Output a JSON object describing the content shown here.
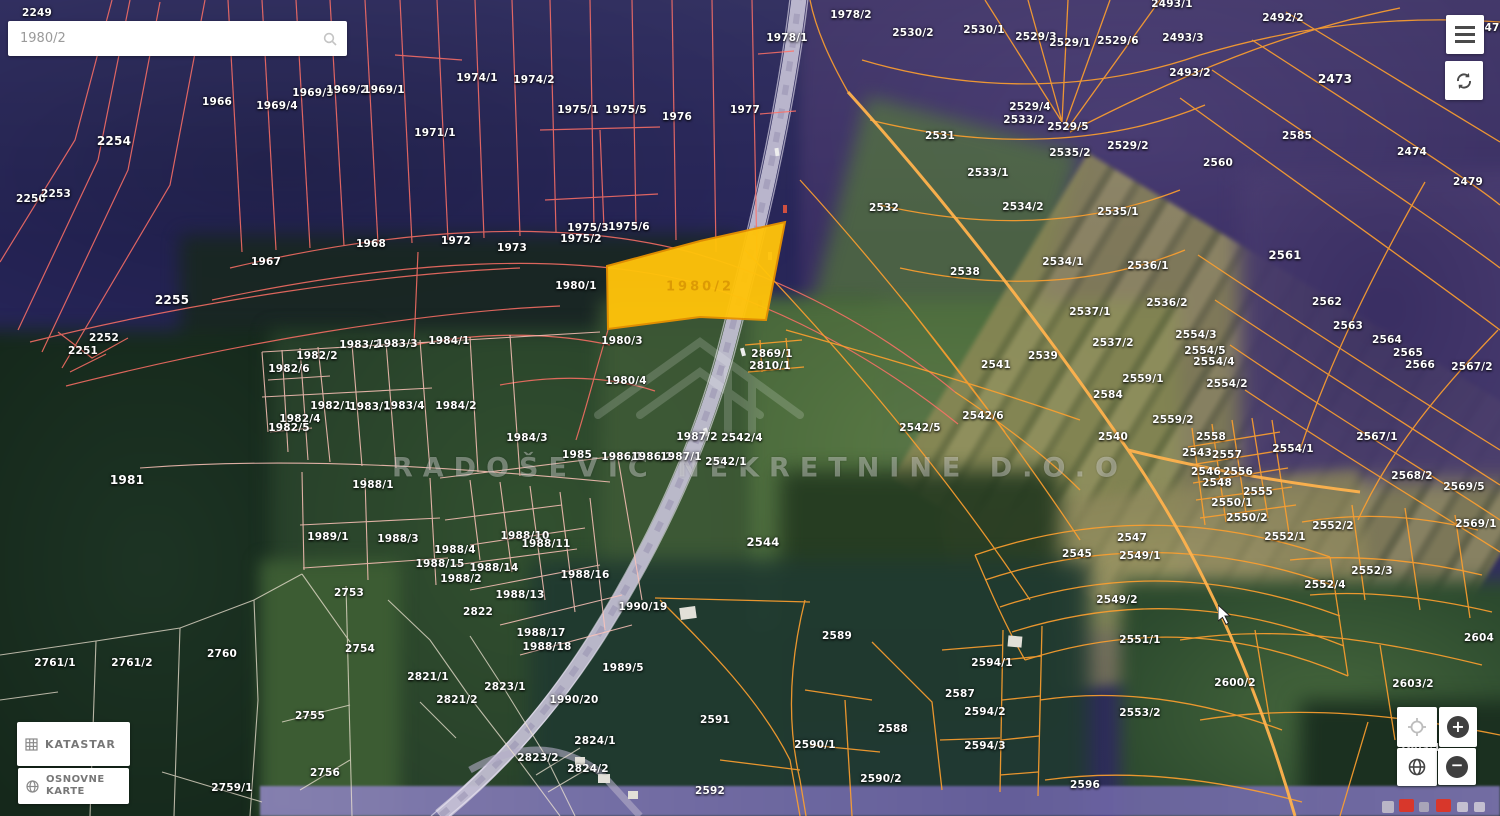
{
  "search": {
    "value": "1980/2",
    "icon": "magnifier-icon"
  },
  "topbar": {
    "menu_icon": "hamburger-icon",
    "refresh_icon": "sync-icon"
  },
  "buttons": {
    "katastar": "KATASTAR",
    "osnovne_karte": "OSNOVNE KARTE",
    "katastar_icon": "grid-icon",
    "osnovne_karte_icon": "globe-icon"
  },
  "controls": {
    "locate_icon": "crosshair-icon",
    "zoom_in": "+",
    "zoom_out": "−",
    "basemap_icon": "globe-icon"
  },
  "watermark": {
    "text": "RADOŠEVIĆ NEKRETNINE D.O.O",
    "logo": "house-logo"
  },
  "highlight": {
    "label": "1980/2",
    "fill": "#ffc30a",
    "stroke": "#e79100"
  },
  "colors": {
    "parcel_line_left": "#ff7066",
    "parcel_line_grid": "#ffc4ba",
    "parcel_line_right": "#ffa02e",
    "parcel_line_white": "#eee3d2",
    "highway": "#c6c1d6",
    "highlight_fill": "#ffc30a"
  },
  "map": {
    "parcels": [
      {
        "n": "2249",
        "x": 37,
        "y": 13
      },
      {
        "n": "1966",
        "x": 217,
        "y": 102
      },
      {
        "n": "1969/4",
        "x": 277,
        "y": 106
      },
      {
        "n": "1969/3",
        "x": 313,
        "y": 93
      },
      {
        "n": "1969/2",
        "x": 347,
        "y": 90
      },
      {
        "n": "1969/1",
        "x": 384,
        "y": 90
      },
      {
        "n": "1971/1",
        "x": 435,
        "y": 133
      },
      {
        "n": "1974/1",
        "x": 477,
        "y": 78
      },
      {
        "n": "1974/2",
        "x": 534,
        "y": 80
      },
      {
        "n": "1975/1",
        "x": 578,
        "y": 110
      },
      {
        "n": "1975/5",
        "x": 626,
        "y": 110
      },
      {
        "n": "1976",
        "x": 677,
        "y": 117
      },
      {
        "n": "1977",
        "x": 745,
        "y": 110
      },
      {
        "n": "1978/1",
        "x": 787,
        "y": 38
      },
      {
        "n": "1978/2",
        "x": 851,
        "y": 15
      },
      {
        "n": "2254",
        "x": 114,
        "y": 141,
        "s": 1.15
      },
      {
        "n": "2250",
        "x": 31,
        "y": 199
      },
      {
        "n": "2253",
        "x": 56,
        "y": 194
      },
      {
        "n": "2255",
        "x": 172,
        "y": 300,
        "s": 1.15
      },
      {
        "n": "2252",
        "x": 104,
        "y": 338
      },
      {
        "n": "2251",
        "x": 83,
        "y": 351
      },
      {
        "n": "1967",
        "x": 266,
        "y": 262
      },
      {
        "n": "1968",
        "x": 371,
        "y": 244
      },
      {
        "n": "1972",
        "x": 456,
        "y": 241
      },
      {
        "n": "1973",
        "x": 512,
        "y": 248
      },
      {
        "n": "1975/3",
        "x": 588,
        "y": 228
      },
      {
        "n": "1975/2",
        "x": 581,
        "y": 239
      },
      {
        "n": "1975/6",
        "x": 629,
        "y": 227
      },
      {
        "n": "1980/1",
        "x": 576,
        "y": 286
      },
      {
        "n": "1980/3",
        "x": 622,
        "y": 341
      },
      {
        "n": "1980/4",
        "x": 626,
        "y": 381
      },
      {
        "n": "1981",
        "x": 127,
        "y": 480,
        "s": 1.15
      },
      {
        "n": "1984/1",
        "x": 449,
        "y": 341
      },
      {
        "n": "1983/2",
        "x": 360,
        "y": 345
      },
      {
        "n": "1983/3",
        "x": 397,
        "y": 344
      },
      {
        "n": "1982/2",
        "x": 317,
        "y": 356
      },
      {
        "n": "1982/6",
        "x": 289,
        "y": 369
      },
      {
        "n": "1982/1",
        "x": 331,
        "y": 406
      },
      {
        "n": "1983/1",
        "x": 370,
        "y": 407
      },
      {
        "n": "1983/4",
        "x": 404,
        "y": 406
      },
      {
        "n": "1984/2",
        "x": 456,
        "y": 406
      },
      {
        "n": "1982/4",
        "x": 300,
        "y": 419
      },
      {
        "n": "1982/5",
        "x": 289,
        "y": 428
      },
      {
        "n": "1984/3",
        "x": 527,
        "y": 438
      },
      {
        "n": "1985",
        "x": 577,
        "y": 455
      },
      {
        "n": "1986/1",
        "x": 622,
        "y": 457
      },
      {
        "n": "1986/2",
        "x": 652,
        "y": 457
      },
      {
        "n": "1987/1",
        "x": 681,
        "y": 457
      },
      {
        "n": "1987/2",
        "x": 697,
        "y": 437
      },
      {
        "n": "2869/1",
        "x": 772,
        "y": 354
      },
      {
        "n": "2810/1",
        "x": 770,
        "y": 366
      },
      {
        "n": "2542/4",
        "x": 742,
        "y": 438
      },
      {
        "n": "2542/1",
        "x": 726,
        "y": 462
      },
      {
        "n": "2542/5",
        "x": 920,
        "y": 428
      },
      {
        "n": "2542/6",
        "x": 983,
        "y": 416
      },
      {
        "n": "2544",
        "x": 763,
        "y": 542,
        "s": 1.1
      },
      {
        "n": "1988/1",
        "x": 373,
        "y": 485
      },
      {
        "n": "1989/1",
        "x": 328,
        "y": 537
      },
      {
        "n": "1988/3",
        "x": 398,
        "y": 539
      },
      {
        "n": "1988/4",
        "x": 455,
        "y": 550
      },
      {
        "n": "1988/15",
        "x": 440,
        "y": 564
      },
      {
        "n": "1988/2",
        "x": 461,
        "y": 579
      },
      {
        "n": "1988/14",
        "x": 494,
        "y": 568
      },
      {
        "n": "1988/10",
        "x": 525,
        "y": 536
      },
      {
        "n": "1988/11",
        "x": 546,
        "y": 544
      },
      {
        "n": "1988/16",
        "x": 585,
        "y": 575
      },
      {
        "n": "1988/13",
        "x": 520,
        "y": 595
      },
      {
        "n": "1988/17",
        "x": 541,
        "y": 633
      },
      {
        "n": "1988/18",
        "x": 547,
        "y": 647
      },
      {
        "n": "1990/19",
        "x": 643,
        "y": 607
      },
      {
        "n": "1989/5",
        "x": 623,
        "y": 668
      },
      {
        "n": "1990/20",
        "x": 574,
        "y": 700
      },
      {
        "n": "2822",
        "x": 478,
        "y": 612
      },
      {
        "n": "2823/1",
        "x": 505,
        "y": 687
      },
      {
        "n": "2823/2",
        "x": 538,
        "y": 758
      },
      {
        "n": "2824/1",
        "x": 595,
        "y": 741
      },
      {
        "n": "2824/2",
        "x": 588,
        "y": 769
      },
      {
        "n": "2821/1",
        "x": 428,
        "y": 677
      },
      {
        "n": "2821/2",
        "x": 457,
        "y": 700
      },
      {
        "n": "2753",
        "x": 349,
        "y": 593
      },
      {
        "n": "2754",
        "x": 360,
        "y": 649
      },
      {
        "n": "2755",
        "x": 310,
        "y": 716
      },
      {
        "n": "2756",
        "x": 325,
        "y": 773
      },
      {
        "n": "2760",
        "x": 222,
        "y": 654
      },
      {
        "n": "2761/1",
        "x": 55,
        "y": 663
      },
      {
        "n": "2761/2",
        "x": 132,
        "y": 663
      },
      {
        "n": "2759/1",
        "x": 232,
        "y": 788
      },
      {
        "n": "2591",
        "x": 715,
        "y": 720
      },
      {
        "n": "2592",
        "x": 710,
        "y": 791
      },
      {
        "n": "2589",
        "x": 837,
        "y": 636
      },
      {
        "n": "2590/1",
        "x": 815,
        "y": 745
      },
      {
        "n": "2590/2",
        "x": 881,
        "y": 779
      },
      {
        "n": "2588",
        "x": 893,
        "y": 729
      },
      {
        "n": "2587",
        "x": 960,
        "y": 694
      },
      {
        "n": "2594/1",
        "x": 992,
        "y": 663
      },
      {
        "n": "2594/2",
        "x": 985,
        "y": 712
      },
      {
        "n": "2594/3",
        "x": 985,
        "y": 746
      },
      {
        "n": "2596",
        "x": 1085,
        "y": 785
      },
      {
        "n": "2530/2",
        "x": 913,
        "y": 33
      },
      {
        "n": "2530/1",
        "x": 984,
        "y": 30
      },
      {
        "n": "2529/3",
        "x": 1036,
        "y": 37
      },
      {
        "n": "2529/1",
        "x": 1070,
        "y": 43
      },
      {
        "n": "2529/6",
        "x": 1118,
        "y": 41
      },
      {
        "n": "2493/1",
        "x": 1172,
        "y": 4
      },
      {
        "n": "2493/3",
        "x": 1183,
        "y": 38
      },
      {
        "n": "2493/2",
        "x": 1190,
        "y": 73
      },
      {
        "n": "2492/2",
        "x": 1283,
        "y": 18
      },
      {
        "n": "2473",
        "x": 1335,
        "y": 79,
        "s": 1.15
      },
      {
        "n": "2475",
        "x": 1492,
        "y": 28
      },
      {
        "n": "2529/4",
        "x": 1030,
        "y": 107
      },
      {
        "n": "2533/2",
        "x": 1024,
        "y": 120
      },
      {
        "n": "2529/5",
        "x": 1068,
        "y": 127
      },
      {
        "n": "2531",
        "x": 940,
        "y": 136
      },
      {
        "n": "2529/2",
        "x": 1128,
        "y": 146
      },
      {
        "n": "2535/2",
        "x": 1070,
        "y": 153
      },
      {
        "n": "2533/1",
        "x": 988,
        "y": 173
      },
      {
        "n": "2532",
        "x": 884,
        "y": 208
      },
      {
        "n": "2534/2",
        "x": 1023,
        "y": 207
      },
      {
        "n": "2535/1",
        "x": 1118,
        "y": 212
      },
      {
        "n": "2560",
        "x": 1218,
        "y": 163
      },
      {
        "n": "2585",
        "x": 1297,
        "y": 136
      },
      {
        "n": "2474",
        "x": 1412,
        "y": 152
      },
      {
        "n": "2479",
        "x": 1468,
        "y": 182
      },
      {
        "n": "2538",
        "x": 965,
        "y": 272
      },
      {
        "n": "2534/1",
        "x": 1063,
        "y": 262
      },
      {
        "n": "2536/1",
        "x": 1148,
        "y": 266
      },
      {
        "n": "2537/1",
        "x": 1090,
        "y": 312
      },
      {
        "n": "2536/2",
        "x": 1167,
        "y": 303
      },
      {
        "n": "2537/2",
        "x": 1113,
        "y": 343
      },
      {
        "n": "2539",
        "x": 1043,
        "y": 356
      },
      {
        "n": "2541",
        "x": 996,
        "y": 365
      },
      {
        "n": "2584",
        "x": 1108,
        "y": 395
      },
      {
        "n": "2559/1",
        "x": 1143,
        "y": 379
      },
      {
        "n": "2559/2",
        "x": 1173,
        "y": 420
      },
      {
        "n": "2540",
        "x": 1113,
        "y": 437
      },
      {
        "n": "2561",
        "x": 1285,
        "y": 255,
        "s": 1.1
      },
      {
        "n": "2562",
        "x": 1327,
        "y": 302
      },
      {
        "n": "2563",
        "x": 1348,
        "y": 326
      },
      {
        "n": "2564",
        "x": 1387,
        "y": 340
      },
      {
        "n": "2565",
        "x": 1408,
        "y": 353
      },
      {
        "n": "2566",
        "x": 1420,
        "y": 365
      },
      {
        "n": "2567/2",
        "x": 1472,
        "y": 367
      },
      {
        "n": "2567/1",
        "x": 1377,
        "y": 437
      },
      {
        "n": "2554/3",
        "x": 1196,
        "y": 335
      },
      {
        "n": "2554/5",
        "x": 1205,
        "y": 351
      },
      {
        "n": "2554/4",
        "x": 1214,
        "y": 362
      },
      {
        "n": "2554/2",
        "x": 1227,
        "y": 384
      },
      {
        "n": "2554/1",
        "x": 1293,
        "y": 449
      },
      {
        "n": "2558",
        "x": 1211,
        "y": 437
      },
      {
        "n": "2543",
        "x": 1197,
        "y": 453
      },
      {
        "n": "2557",
        "x": 1227,
        "y": 455
      },
      {
        "n": "2546",
        "x": 1206,
        "y": 472
      },
      {
        "n": "2556",
        "x": 1238,
        "y": 472
      },
      {
        "n": "2548",
        "x": 1217,
        "y": 483
      },
      {
        "n": "2555",
        "x": 1258,
        "y": 492
      },
      {
        "n": "2550/1",
        "x": 1232,
        "y": 503
      },
      {
        "n": "2550/2",
        "x": 1247,
        "y": 518
      },
      {
        "n": "2545",
        "x": 1077,
        "y": 554
      },
      {
        "n": "2547",
        "x": 1132,
        "y": 538
      },
      {
        "n": "2549/1",
        "x": 1140,
        "y": 556
      },
      {
        "n": "2549/2",
        "x": 1117,
        "y": 600
      },
      {
        "n": "2551/1",
        "x": 1140,
        "y": 640
      },
      {
        "n": "2553/2",
        "x": 1140,
        "y": 713
      },
      {
        "n": "2568/2",
        "x": 1412,
        "y": 476
      },
      {
        "n": "2569/5",
        "x": 1464,
        "y": 487
      },
      {
        "n": "2569/1",
        "x": 1476,
        "y": 524
      },
      {
        "n": "2552/2",
        "x": 1333,
        "y": 526
      },
      {
        "n": "2552/1",
        "x": 1285,
        "y": 537
      },
      {
        "n": "2552/3",
        "x": 1372,
        "y": 571
      },
      {
        "n": "2552/4",
        "x": 1325,
        "y": 585
      },
      {
        "n": "2604",
        "x": 1479,
        "y": 638
      },
      {
        "n": "2600/2",
        "x": 1235,
        "y": 683
      },
      {
        "n": "2603/2",
        "x": 1413,
        "y": 684
      },
      {
        "n": "2603/1",
        "x": 1420,
        "y": 748
      }
    ]
  }
}
